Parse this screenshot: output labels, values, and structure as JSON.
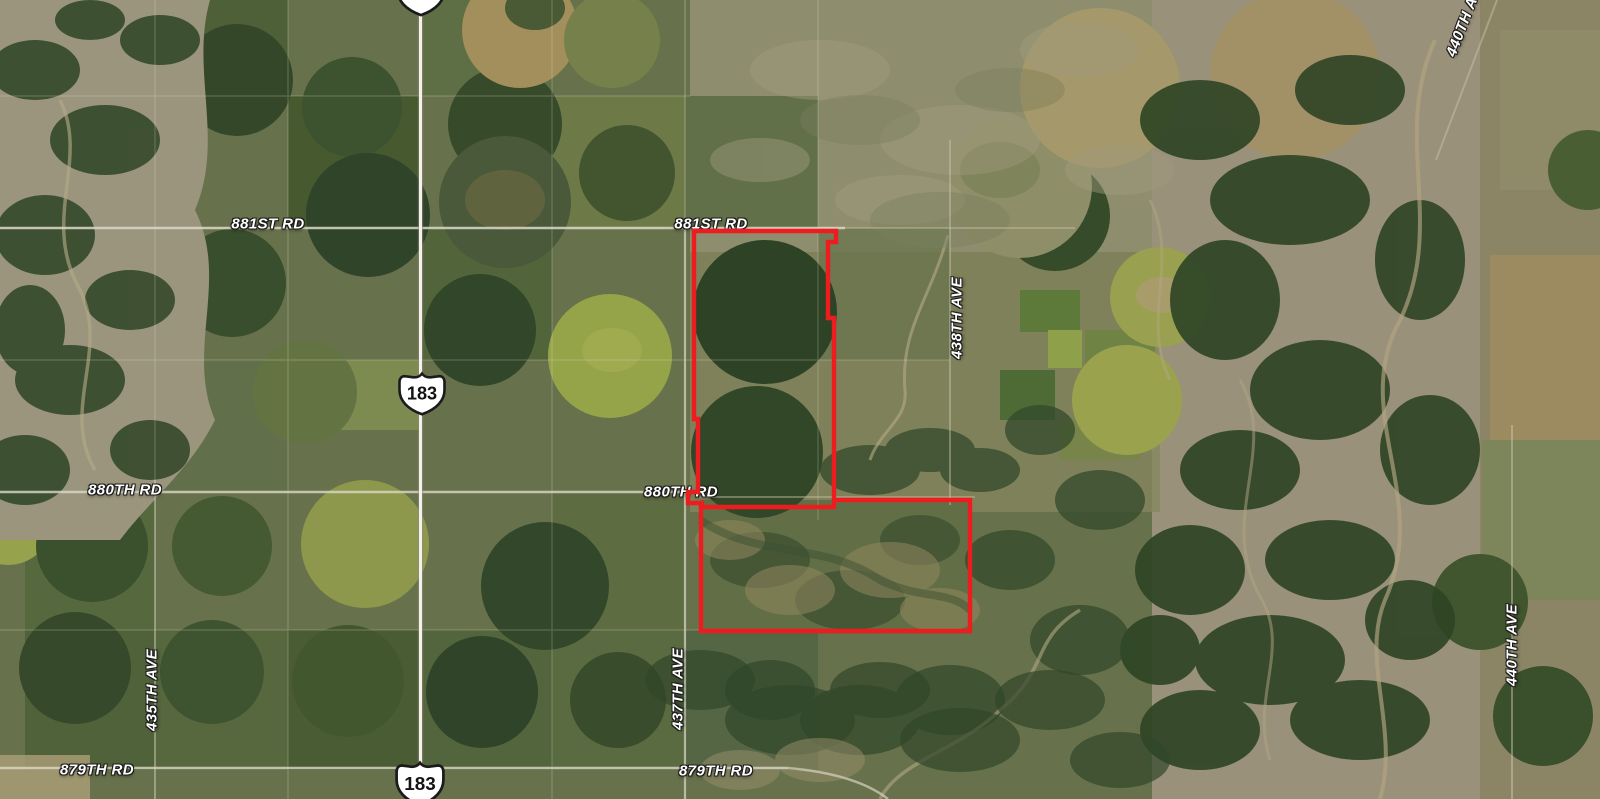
{
  "map": {
    "boundary": {
      "color": "#ed1c1e"
    },
    "highway_shields": [
      {
        "number": "183",
        "position": "top"
      },
      {
        "number": "183",
        "position": "middle"
      },
      {
        "number": "183",
        "position": "bottom"
      }
    ],
    "road_labels": [
      {
        "text": "881ST RD",
        "position": "west",
        "orientation": "horizontal"
      },
      {
        "text": "881ST RD",
        "position": "center",
        "orientation": "horizontal"
      },
      {
        "text": "880TH RD",
        "position": "west",
        "orientation": "horizontal"
      },
      {
        "text": "880TH RD",
        "position": "center",
        "orientation": "horizontal"
      },
      {
        "text": "879TH RD",
        "position": "west",
        "orientation": "horizontal"
      },
      {
        "text": "879TH RD",
        "position": "center",
        "orientation": "horizontal"
      },
      {
        "text": "435TH AVE",
        "position": "southwest",
        "orientation": "vertical"
      },
      {
        "text": "437TH AVE",
        "position": "south-center",
        "orientation": "vertical"
      },
      {
        "text": "438TH AVE",
        "position": "east-center",
        "orientation": "vertical"
      },
      {
        "text": "440TH AVE",
        "position": "southeast",
        "orientation": "vertical"
      },
      {
        "text": "440TH A",
        "position": "northeast-corner",
        "orientation": "diagonal"
      }
    ]
  }
}
